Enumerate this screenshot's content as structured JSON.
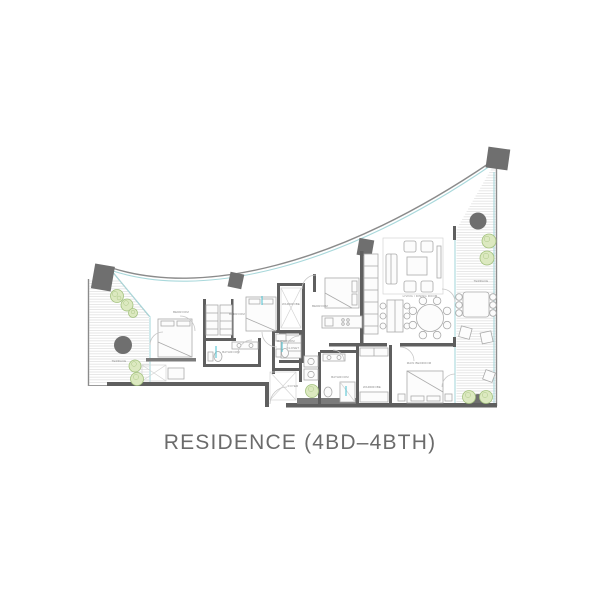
{
  "title": "RESIDENCE (4BD–4BTH)",
  "plan": {
    "labels": {
      "terrace_left": "TERRACE",
      "bedroom_1": "BEDROOM",
      "bedroom_2": "BEDROOM",
      "bedroom_3": "BEDROOM",
      "walk_in": "WARDROBE",
      "closet": "CLOSET",
      "bathroom_1": "BATHROOM",
      "powder": "BATHROOM",
      "living_dining": "LIVING / DINING ROOM",
      "terrace_right": "TERRACE",
      "main_bedroom": "MAIN BEDROOM",
      "bathroom_2": "BATHROOM",
      "wardrobe": "WARDROBE",
      "foyer": "FOYER"
    },
    "colors": {
      "wall": "#5f5f5f",
      "column": "#6f6f6f",
      "outline": "#9a9a9a",
      "edge": "#8b8b8b",
      "glass": "#a9d8db",
      "hatch": "#e4e4e4",
      "tree_fill": "#dce9c0",
      "tree_stroke": "#a3c27e",
      "label": "#8a8a8a",
      "title_color": "#6b6b6b",
      "furniture": "#aaaaaa",
      "furniture_fill": "#fcfcfc",
      "accent": "#57c5d4"
    },
    "icons": [
      "tree-icon",
      "column-icon",
      "bed-icon",
      "sofa-icon",
      "armchair-icon",
      "coffee-table-icon",
      "dining-table-icon",
      "kitchen-island-icon",
      "outdoor-table-icon",
      "lounge-chair-icon",
      "door-arc-icon",
      "toilet-icon",
      "sink-icon",
      "washer-icon",
      "wardrobe-x-icon"
    ]
  }
}
